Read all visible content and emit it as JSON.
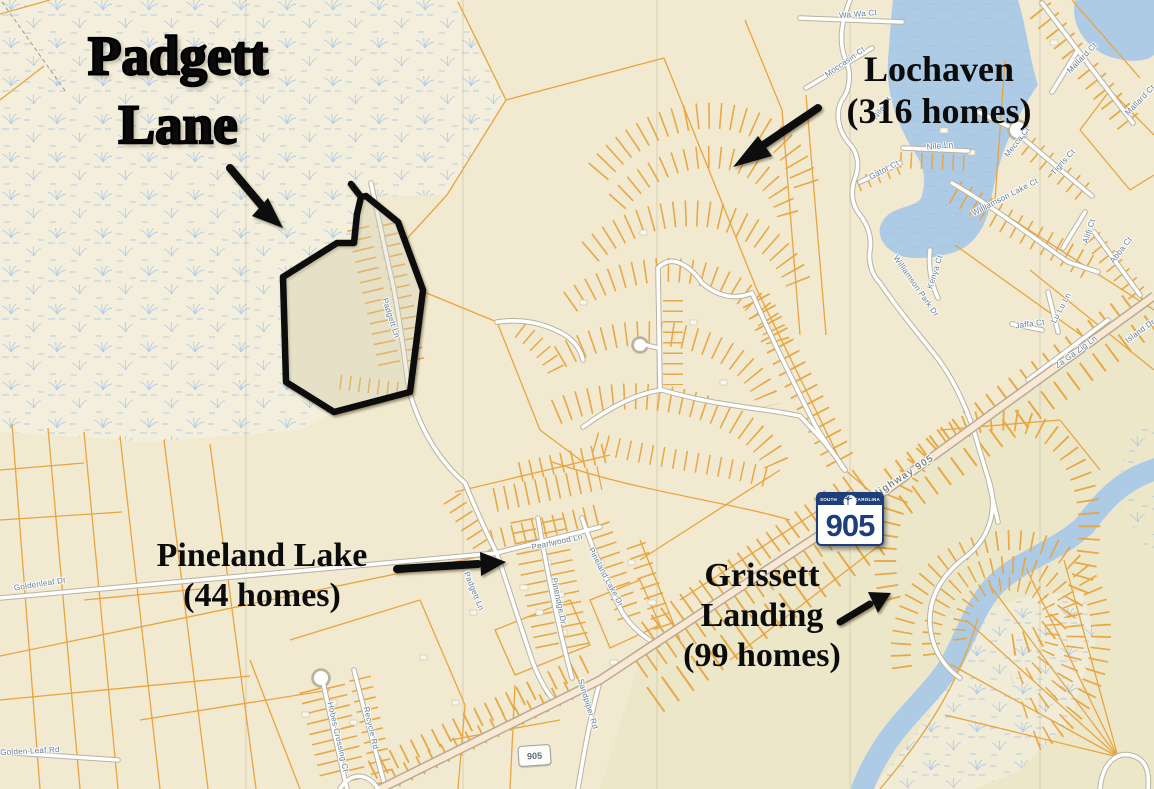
{
  "map": {
    "title_block": {
      "line1": "Padgett",
      "line2": "Lane"
    },
    "callouts": {
      "lochaven": {
        "name": "Lochaven",
        "homes": "(316 homes)"
      },
      "pineland": {
        "name": "Pineland Lake",
        "homes": "(44 homes)"
      },
      "grissett": {
        "line1": "Grissett",
        "line2": "Landing",
        "homes": "(99 homes)"
      }
    },
    "shield": {
      "state_left": "SOUTH",
      "state_right": "CAROLINA",
      "number": "905"
    },
    "mini_shield": {
      "number": "905"
    },
    "colors": {
      "base": "#F1EACF",
      "wetland_base": "#F3EFDC",
      "wetland_mark": "#A9C6E3",
      "parcel_line": "#E9A43F",
      "water": "#AECBE6",
      "road_fill": "#FFFFFF",
      "highway_fill": "#F8E8D4",
      "annotation": "#0B0B0B",
      "street_label": "#64819C",
      "shield_blue": "#1E3D7B"
    },
    "street_labels": [
      {
        "text": "Wa Wa Ct",
        "x": 858,
        "y": 14,
        "rot": -5,
        "size": 8
      },
      {
        "text": "Moccasin Ct",
        "x": 845,
        "y": 62,
        "rot": -35,
        "size": 8
      },
      {
        "text": "Mallard Ct",
        "x": 1082,
        "y": 58,
        "rot": -46,
        "size": 8
      },
      {
        "text": "Mallard Ct",
        "x": 1140,
        "y": 100,
        "rot": -46,
        "size": 8
      },
      {
        "text": "Nile Ct",
        "x": 882,
        "y": 108,
        "rot": -55,
        "size": 8
      },
      {
        "text": "Gator Ct",
        "x": 884,
        "y": 170,
        "rot": -28,
        "size": 8
      },
      {
        "text": "Nile Ln",
        "x": 940,
        "y": 146,
        "rot": -6,
        "size": 8
      },
      {
        "text": "Mecca Ct",
        "x": 1017,
        "y": 142,
        "rot": -52,
        "size": 8
      },
      {
        "text": "Tigris Ct",
        "x": 1063,
        "y": 162,
        "rot": -48,
        "size": 8
      },
      {
        "text": "Williamson Lake Ct",
        "x": 1005,
        "y": 197,
        "rot": -27,
        "size": 8
      },
      {
        "text": "Alifi Ct",
        "x": 1089,
        "y": 231,
        "rot": -72,
        "size": 8
      },
      {
        "text": "Abba Ct",
        "x": 1121,
        "y": 250,
        "rot": -52,
        "size": 8
      },
      {
        "text": "Kenya Ct",
        "x": 935,
        "y": 272,
        "rot": -72,
        "size": 8
      },
      {
        "text": "Williamson Park Dr",
        "x": 916,
        "y": 286,
        "rot": 55,
        "size": 8
      },
      {
        "text": "Lu Lu Ln",
        "x": 1061,
        "y": 308,
        "rot": -62,
        "size": 8
      },
      {
        "text": "Jaffa Ct",
        "x": 1030,
        "y": 324,
        "rot": -8,
        "size": 8
      },
      {
        "text": "Za Ga Zig Ln",
        "x": 1076,
        "y": 352,
        "rot": -36,
        "size": 8
      },
      {
        "text": "Island Dr",
        "x": 1140,
        "y": 331,
        "rot": -36,
        "size": 8
      },
      {
        "text": "Padgett Ln",
        "x": 391,
        "y": 318,
        "rot": 72,
        "size": 8
      },
      {
        "text": "Padgett Ln",
        "x": 474,
        "y": 591,
        "rot": 68,
        "size": 8
      },
      {
        "text": "Pearlwood Ln",
        "x": 557,
        "y": 542,
        "rot": -12,
        "size": 8
      },
      {
        "text": "Pineridge Dr",
        "x": 559,
        "y": 601,
        "rot": 78,
        "size": 8
      },
      {
        "text": "Pineland Lake Dr",
        "x": 606,
        "y": 577,
        "rot": 62,
        "size": 8
      },
      {
        "text": "Goldenleaf Dr",
        "x": 40,
        "y": 584,
        "rot": -9,
        "size": 8
      },
      {
        "text": "Golden Leaf Rd",
        "x": 30,
        "y": 751,
        "rot": -3,
        "size": 8
      },
      {
        "text": "Hobes Crossing Ct",
        "x": 338,
        "y": 737,
        "rot": 77,
        "size": 8
      },
      {
        "text": "Recycle Rd",
        "x": 371,
        "y": 728,
        "rot": 77,
        "size": 8
      },
      {
        "text": "Sandpiper Rd",
        "x": 588,
        "y": 704,
        "rot": 73,
        "size": 8
      },
      {
        "text": "Highway 905",
        "x": 903,
        "y": 477,
        "rot": -33,
        "size": 10,
        "cls": "hwy-label"
      }
    ]
  }
}
